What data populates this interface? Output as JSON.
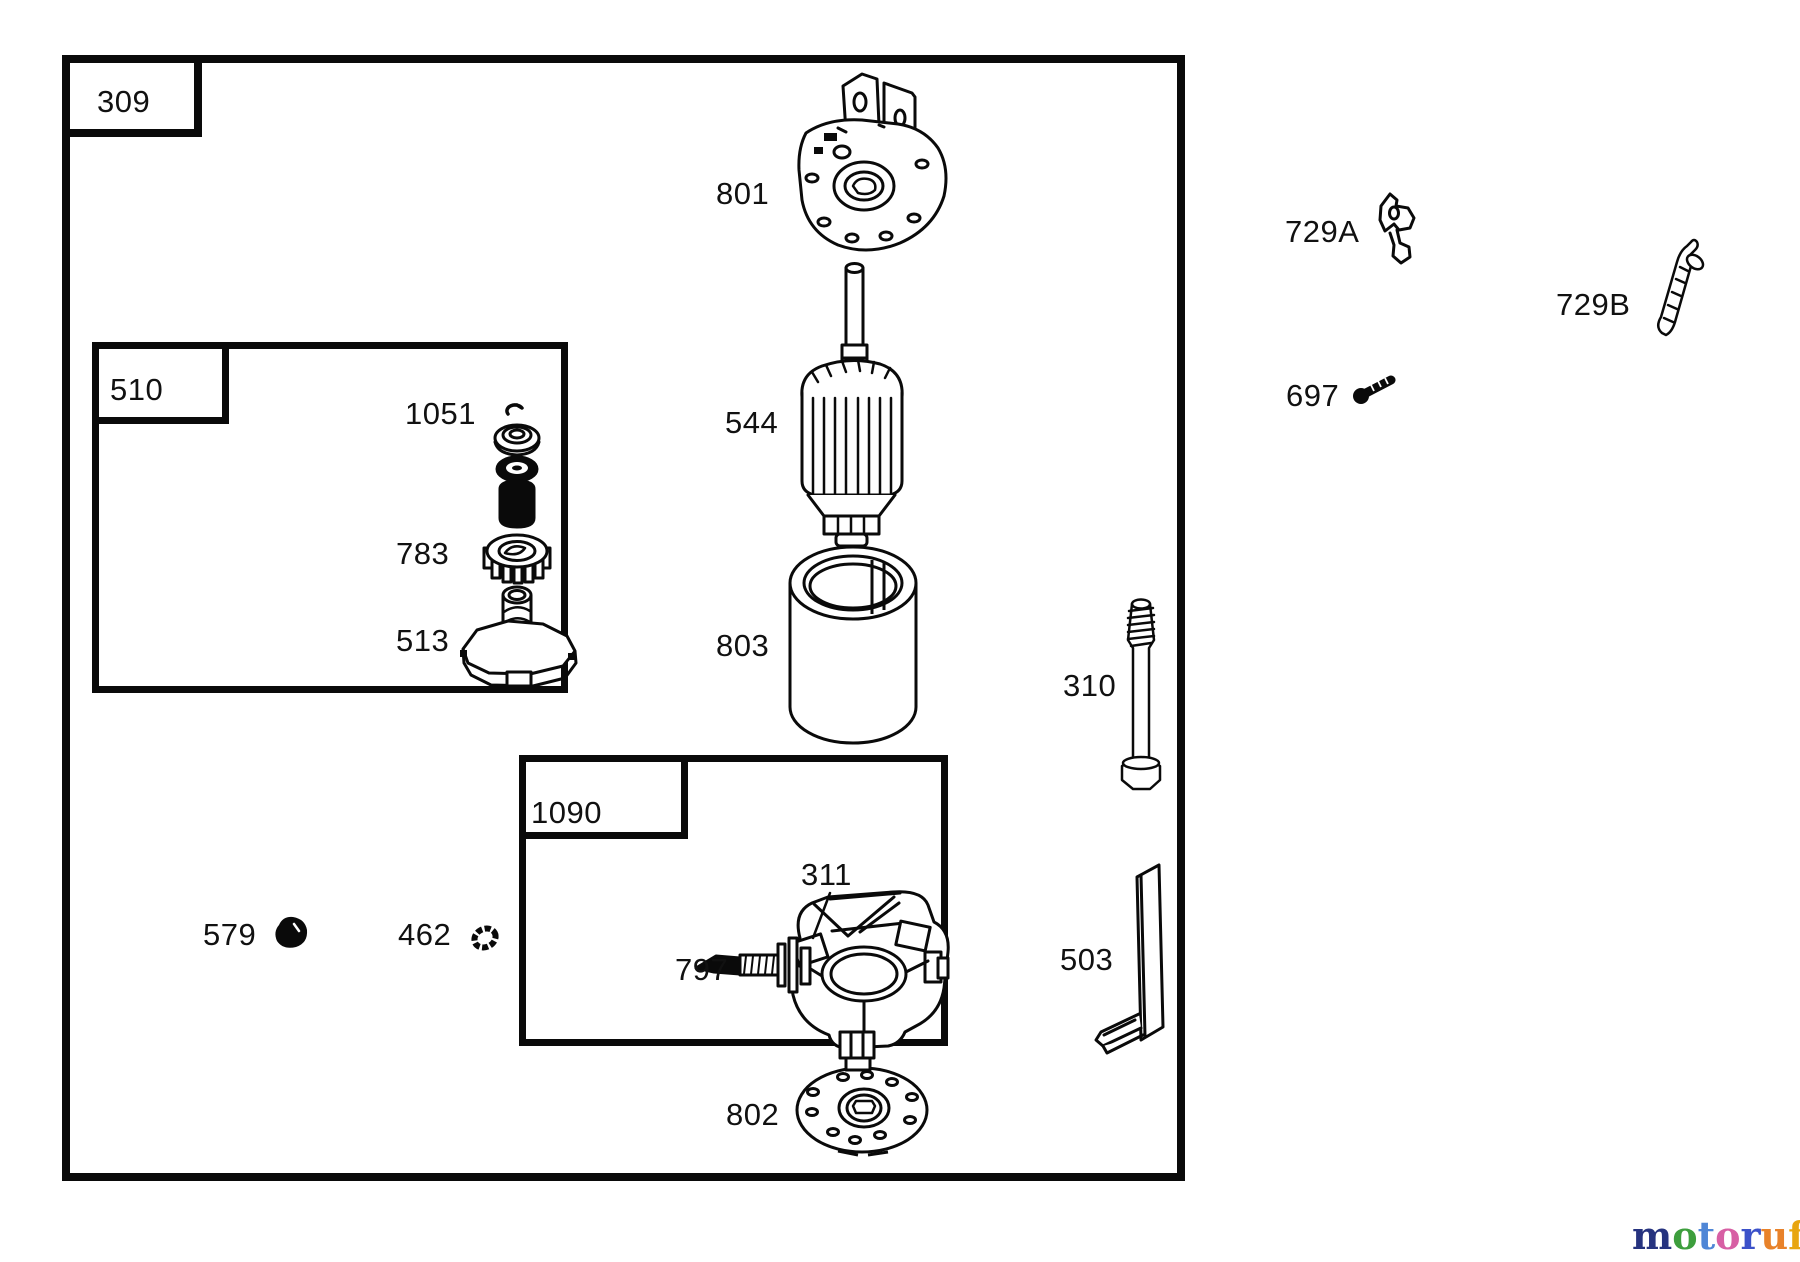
{
  "frames": {
    "main": {
      "label": "309"
    },
    "gear_group": {
      "label": "510"
    },
    "brush_group": {
      "label": "1090"
    }
  },
  "part_labels": {
    "bracket": "801",
    "armature": "544",
    "housing": "803",
    "end_plate": "802",
    "retainer_kit": "1051",
    "pinion_gear": "783",
    "clutch": "513",
    "through_bolt": "310",
    "bracket_strip": "503",
    "dust_cap": "579",
    "washer": "462",
    "brush_holder": "311",
    "terminal": "797",
    "clip_a": "729A",
    "clip_b": "729B",
    "screw": "697"
  },
  "watermark": {
    "letters": [
      "m",
      "o",
      "t",
      "o",
      "r",
      "u",
      "f"
    ],
    "letter_colors": [
      "#26337f",
      "#3d9e3d",
      "#4f86d6",
      "#d75fa4",
      "#3b51c9",
      "#e8822a",
      "#e8a50f"
    ],
    "suffix": ".de",
    "suffix_color": "#4a4a4a"
  },
  "colors": {
    "line": "#0a0a0a",
    "background": "#ffffff"
  }
}
